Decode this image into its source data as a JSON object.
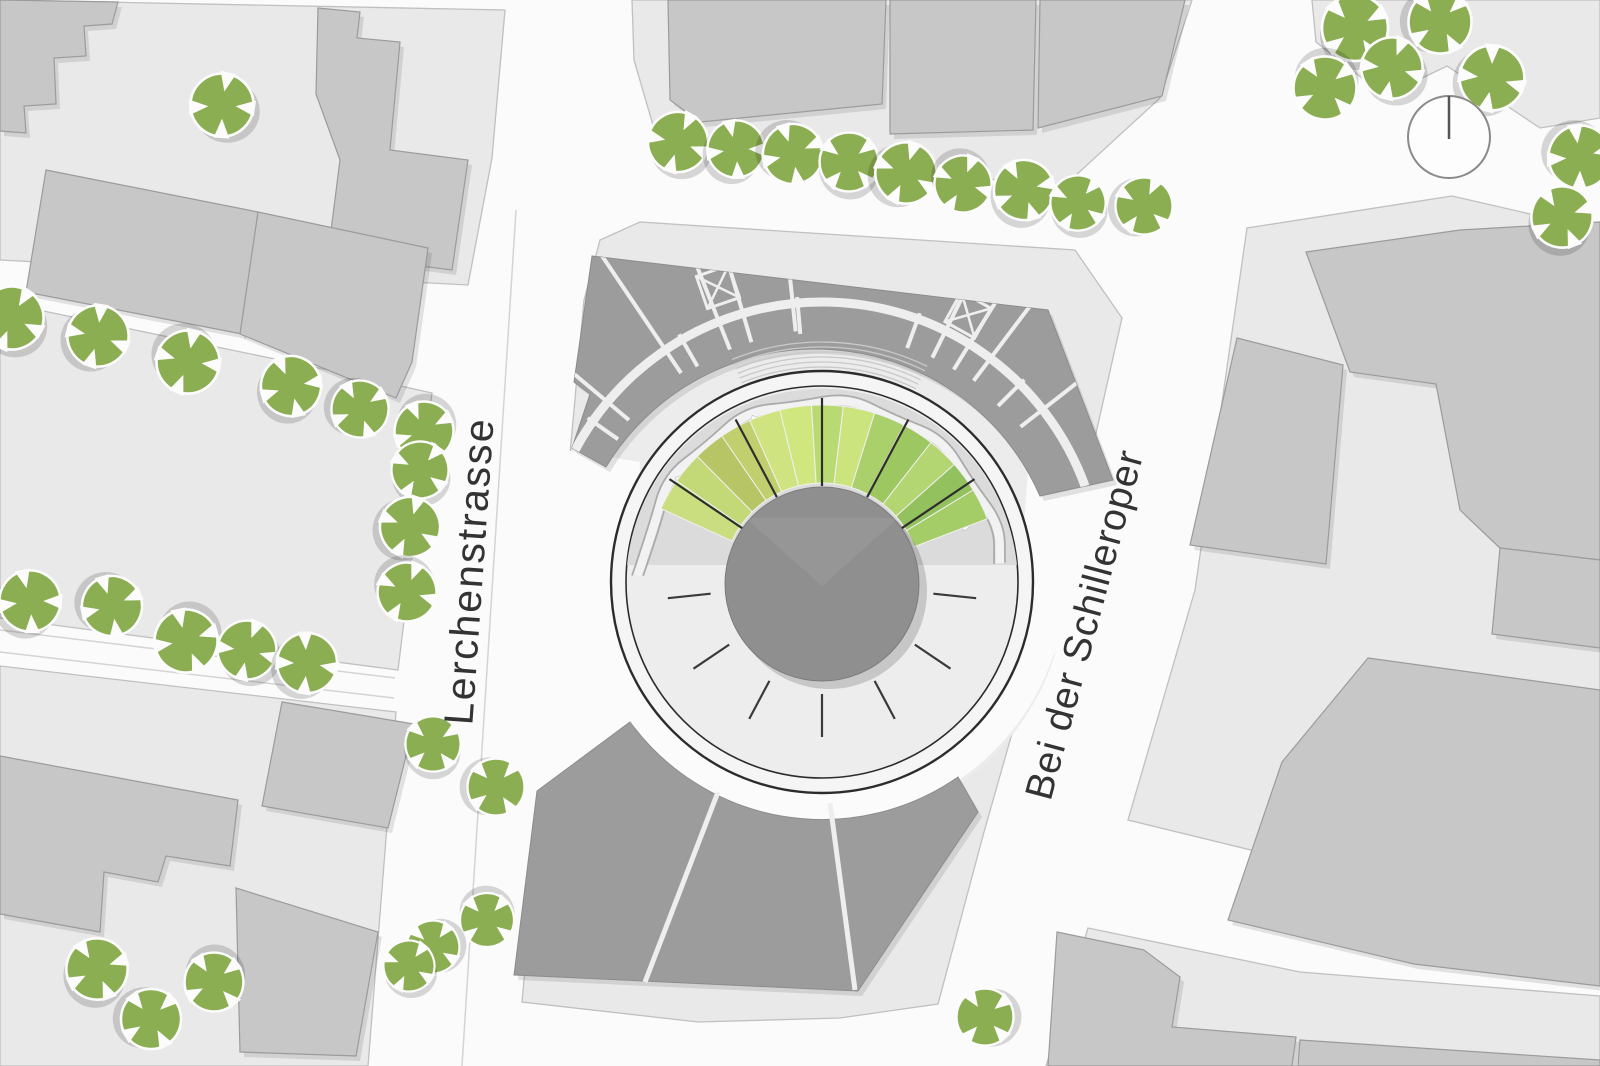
{
  "labels": {
    "street_west": "Lerchenstrasse",
    "street_east": "Bei der Schilleroper"
  },
  "label_style": {
    "west": {
      "x": 483,
      "y": 572,
      "rotation": -86,
      "size": 41,
      "spacing": 2
    },
    "east": {
      "x": 1097,
      "y": 628,
      "rotation": -75,
      "size": 39,
      "spacing": 1
    }
  },
  "colors": {
    "street": "#fbfbfb",
    "plot": "#e9e9e9",
    "plot_stroke": "#c0c0c0",
    "building": "#c7c7c7",
    "building_stroke": "#9b9b9b",
    "dark_block": "#9c9c9c",
    "dark_block_stroke": "#8c8c8c",
    "divider": "#eeeeee",
    "apron": "#ececec",
    "ring_fill": "#f5f5f5",
    "ring_stroke": "#2c2c2c",
    "inner_fill": "#ededed",
    "landscape": "#dbdbdb",
    "path_line": "#ababab",
    "center_circle": "#8f8f8f",
    "tree": "#8cae52",
    "label": "#333333",
    "tick": "#3a3a3a",
    "hatch": "#c9c9c9",
    "north_stroke": "#8a8a8a"
  },
  "north_symbol": {
    "cx": 1449,
    "cy": 137,
    "r": 41
  },
  "plaza": {
    "cx": 822,
    "cy": 582,
    "r_outer": 211,
    "r_inner": 196,
    "r_apron": 244,
    "r_center": 97,
    "fan": {
      "r0": 99,
      "r1": 177,
      "a_start": 155.5,
      "a_end": 20.95,
      "colors": [
        "#cade7f",
        "#c3d877",
        "#b7c566",
        "#c2cf6e",
        "#cfe480",
        "#d0e67e",
        "#b9da73",
        "#cce47e",
        "#a9d06a",
        "#9cc761",
        "#b3d572",
        "#93c15d",
        "#a4cc67"
      ]
    },
    "fan_lines": [
      34,
      62,
      90,
      118,
      146
    ],
    "tick_angles": [
      186,
      214,
      242,
      270,
      298,
      326,
      354
    ],
    "tick_r": [
      112,
      155
    ],
    "stairs": {
      "a1": 64,
      "a2": 112,
      "r_from": 200,
      "r_to": 240,
      "step": 5
    },
    "wavy": {
      "angles": [
        178,
        162,
        146,
        130,
        114,
        98,
        82,
        66,
        50,
        34,
        18,
        6
      ],
      "radii": [
        190,
        182,
        192,
        182,
        192,
        182,
        192,
        182,
        192,
        182,
        192,
        184
      ],
      "offset2": 11
    },
    "benches": [
      {
        "x": 752,
        "y": 428,
        "rot": 20
      },
      {
        "x": 688,
        "y": 479,
        "rot": 80
      },
      {
        "x": 960,
        "y": 519,
        "rot": -40
      }
    ]
  },
  "plots": [
    {
      "name": "block-northwest",
      "pts": [
        [
          0,
          0
        ],
        [
          505,
          10
        ],
        [
          492,
          158
        ],
        [
          468,
          285
        ],
        [
          0,
          260
        ]
      ]
    },
    {
      "name": "park-west",
      "pts": [
        [
          0,
          302
        ],
        [
          352,
          375
        ],
        [
          432,
          393
        ],
        [
          398,
          670
        ],
        [
          0,
          618
        ]
      ]
    },
    {
      "name": "block-southwest",
      "pts": [
        [
          0,
          666
        ],
        [
          396,
          712
        ],
        [
          368,
          1066
        ],
        [
          0,
          1066
        ]
      ]
    },
    {
      "name": "block-central",
      "pts": [
        [
          640,
          222
        ],
        [
          1075,
          250
        ],
        [
          1122,
          318
        ],
        [
          1094,
          442
        ],
        [
          1038,
          642
        ],
        [
          984,
          832
        ],
        [
          938,
          1004
        ],
        [
          840,
          1018
        ],
        [
          698,
          1022
        ],
        [
          522,
          1002
        ],
        [
          544,
          758
        ],
        [
          566,
          498
        ],
        [
          584,
          300
        ],
        [
          600,
          240
        ]
      ]
    },
    {
      "name": "block-north",
      "pts": [
        [
          632,
          0
        ],
        [
          1192,
          0
        ],
        [
          1160,
          98
        ],
        [
          1062,
          188
        ],
        [
          900,
          168
        ],
        [
          755,
          148
        ],
        [
          655,
          132
        ],
        [
          634,
          60
        ]
      ]
    },
    {
      "name": "block-northeast",
      "pts": [
        [
          1312,
          0
        ],
        [
          1600,
          0
        ],
        [
          1600,
          118
        ],
        [
          1540,
          128
        ],
        [
          1447,
          66
        ],
        [
          1385,
          96
        ],
        [
          1316,
          42
        ]
      ]
    },
    {
      "name": "block-east",
      "pts": [
        [
          1247,
          228
        ],
        [
          1452,
          196
        ],
        [
          1600,
          230
        ],
        [
          1600,
          898
        ],
        [
          1300,
          862
        ],
        [
          1128,
          820
        ],
        [
          1195,
          590
        ]
      ]
    },
    {
      "name": "block-southeast",
      "pts": [
        [
          1088,
          928
        ],
        [
          1300,
          972
        ],
        [
          1600,
          996
        ],
        [
          1600,
          1066
        ],
        [
          1046,
          1066
        ]
      ]
    }
  ],
  "street_patches": [
    {
      "name": "plaza-west-opening",
      "pts": [
        [
          552,
          448
        ],
        [
          640,
          462
        ],
        [
          628,
          790
        ],
        [
          516,
          806
        ]
      ]
    },
    {
      "name": "plaza-east-opening",
      "pts": [
        [
          1028,
          470
        ],
        [
          1100,
          452
        ],
        [
          1070,
          640
        ],
        [
          1012,
          690
        ]
      ]
    }
  ],
  "detail_lines": [
    {
      "x1": 0,
      "y1": 630,
      "x2": 395,
      "y2": 678
    },
    {
      "x1": 0,
      "y1": 652,
      "x2": 394,
      "y2": 698
    },
    {
      "x1": 516,
      "y1": 210,
      "x2": 462,
      "y2": 1066
    }
  ],
  "buildings": [
    {
      "name": "nw-perimeter-west",
      "pts": [
        [
          0,
          0
        ],
        [
          118,
          2
        ],
        [
          112,
          24
        ],
        [
          84,
          26
        ],
        [
          86,
          56
        ],
        [
          54,
          58
        ],
        [
          56,
          104
        ],
        [
          24,
          106
        ],
        [
          26,
          133
        ],
        [
          0,
          131
        ]
      ]
    },
    {
      "name": "nw-perimeter-east",
      "pts": [
        [
          318,
          8
        ],
        [
          360,
          12
        ],
        [
          357,
          38
        ],
        [
          400,
          42
        ],
        [
          390,
          150
        ],
        [
          468,
          160
        ],
        [
          452,
          270
        ],
        [
          328,
          254
        ],
        [
          340,
          160
        ],
        [
          316,
          94
        ]
      ]
    },
    {
      "name": "nw-slab-a",
      "pts": [
        [
          46,
          170
        ],
        [
          258,
          212
        ],
        [
          242,
          334
        ],
        [
          26,
          292
        ]
      ]
    },
    {
      "name": "nw-slab-b",
      "pts": [
        [
          258,
          212
        ],
        [
          428,
          248
        ],
        [
          412,
          362
        ],
        [
          396,
          398
        ],
        [
          240,
          334
        ]
      ]
    },
    {
      "name": "north-slab-a",
      "pts": [
        [
          668,
          0
        ],
        [
          886,
          0
        ],
        [
          882,
          104
        ],
        [
          700,
          122
        ],
        [
          670,
          100
        ]
      ]
    },
    {
      "name": "north-slab-b",
      "pts": [
        [
          890,
          0
        ],
        [
          1036,
          0
        ],
        [
          1033,
          130
        ],
        [
          890,
          134
        ]
      ]
    },
    {
      "name": "north-slab-c",
      "pts": [
        [
          1040,
          0
        ],
        [
          1185,
          0
        ],
        [
          1162,
          96
        ],
        [
          1038,
          128
        ]
      ]
    },
    {
      "name": "east-slab-street",
      "pts": [
        [
          1237,
          338
        ],
        [
          1343,
          365
        ],
        [
          1326,
          564
        ],
        [
          1190,
          545
        ]
      ]
    },
    {
      "name": "east-large",
      "pts": [
        [
          1306,
          252
        ],
        [
          1460,
          230
        ],
        [
          1600,
          222
        ],
        [
          1600,
          560
        ],
        [
          1500,
          548
        ],
        [
          1460,
          510
        ],
        [
          1436,
          384
        ],
        [
          1350,
          372
        ]
      ]
    },
    {
      "name": "east-large-annex",
      "pts": [
        [
          1500,
          548
        ],
        [
          1600,
          560
        ],
        [
          1600,
          648
        ],
        [
          1492,
          634
        ]
      ]
    },
    {
      "name": "east-south-large",
      "pts": [
        [
          1368,
          658
        ],
        [
          1600,
          690
        ],
        [
          1600,
          986
        ],
        [
          1414,
          964
        ],
        [
          1228,
          920
        ],
        [
          1282,
          762
        ]
      ]
    },
    {
      "name": "se-corner-a",
      "pts": [
        [
          1057,
          932
        ],
        [
          1144,
          950
        ],
        [
          1180,
          977
        ],
        [
          1172,
          1027
        ],
        [
          1296,
          1037
        ],
        [
          1292,
          1066
        ],
        [
          1048,
          1066
        ]
      ]
    },
    {
      "name": "se-corner-b",
      "pts": [
        [
          1300,
          1040
        ],
        [
          1600,
          1060
        ],
        [
          1600,
          1066
        ],
        [
          1298,
          1066
        ]
      ]
    },
    {
      "name": "sw-jagged",
      "pts": [
        [
          0,
          756
        ],
        [
          238,
          800
        ],
        [
          230,
          866
        ],
        [
          166,
          856
        ],
        [
          158,
          882
        ],
        [
          104,
          872
        ],
        [
          100,
          932
        ],
        [
          0,
          914
        ]
      ]
    },
    {
      "name": "sw-upper-right",
      "pts": [
        [
          282,
          702
        ],
        [
          414,
          724
        ],
        [
          388,
          828
        ],
        [
          262,
          806
        ]
      ]
    },
    {
      "name": "sw-lower-right",
      "pts": [
        [
          236,
          888
        ],
        [
          378,
          932
        ],
        [
          356,
          1056
        ],
        [
          240,
          1052
        ]
      ]
    }
  ],
  "dark_blocks": {
    "north": {
      "d": "M592,256 L1048,310 L1113,480 L1040,496 A245,245 0 0 0 606,467 L572,448 L590,394 L574,382 Z",
      "lane": {
        "r": 280,
        "a1": 20,
        "a2": 160
      },
      "outer_dividers": [
        38,
        53,
        96,
        124,
        140,
        156
      ],
      "inner_dividers": [
        45,
        70,
        95,
        120,
        145
      ],
      "corridors": [
        [
          58.2,
          63.8
        ],
        [
          106.4,
          111.6
        ]
      ],
      "x_squares": [
        {
          "x": 968,
          "y": 315,
          "rot": 29
        },
        {
          "x": 718,
          "y": 287,
          "rot": -19
        }
      ]
    },
    "south": {
      "d": "M630,722 A238,238 0 0 0 958,777 L978,812 L858,991 L514,975 L537,791 Z",
      "dividers": [
        {
          "x1": 718,
          "y1": 792,
          "x2": 645,
          "y2": 982
        },
        {
          "x1": 830,
          "y1": 803,
          "x2": 855,
          "y2": 990
        }
      ]
    }
  },
  "trees": [
    [
      222,
      105,
      1.05,
      0
    ],
    [
      678,
      142,
      1,
      15
    ],
    [
      736,
      149,
      0.95,
      80
    ],
    [
      793,
      154,
      1,
      160
    ],
    [
      849,
      162,
      0.98,
      40
    ],
    [
      906,
      173,
      1.02,
      110
    ],
    [
      963,
      184,
      0.95,
      200
    ],
    [
      1024,
      190,
      1,
      65
    ],
    [
      1078,
      203,
      0.92,
      30
    ],
    [
      1144,
      206,
      0.95,
      120
    ],
    [
      1355,
      28,
      1.1,
      50
    ],
    [
      1440,
      22,
      1.05,
      140
    ],
    [
      1392,
      68,
      1.02,
      10
    ],
    [
      1325,
      88,
      1.05,
      230
    ],
    [
      1492,
      78,
      1.08,
      95
    ],
    [
      1580,
      157,
      1.05,
      170
    ],
    [
      1562,
      217,
      1.02,
      60
    ],
    [
      12,
      318,
      1.05,
      20
    ],
    [
      98,
      336,
      1.02,
      100
    ],
    [
      188,
      362,
      1.05,
      190
    ],
    [
      291,
      386,
      1,
      70
    ],
    [
      360,
      409,
      0.95,
      150
    ],
    [
      424,
      431,
      0.98,
      240
    ],
    [
      420,
      470,
      0.95,
      30
    ],
    [
      410,
      527,
      1,
      110
    ],
    [
      407,
      592,
      0.98,
      200
    ],
    [
      30,
      601,
      1.02,
      80
    ],
    [
      112,
      606,
      1,
      160
    ],
    [
      186,
      641,
      1.05,
      250
    ],
    [
      247,
      650,
      0.98,
      10
    ],
    [
      307,
      663,
      1,
      90
    ],
    [
      433,
      744,
      0.92,
      45
    ],
    [
      496,
      787,
      0.95,
      135
    ],
    [
      487,
      920,
      0.9,
      220
    ],
    [
      433,
      947,
      0.88,
      300
    ],
    [
      409,
      966,
      0.85,
      25
    ],
    [
      97,
      969,
      1.02,
      60
    ],
    [
      151,
      1019,
      1,
      140
    ],
    [
      214,
      982,
      0.98,
      230
    ],
    [
      985,
      1017,
      0.95,
      315
    ]
  ]
}
